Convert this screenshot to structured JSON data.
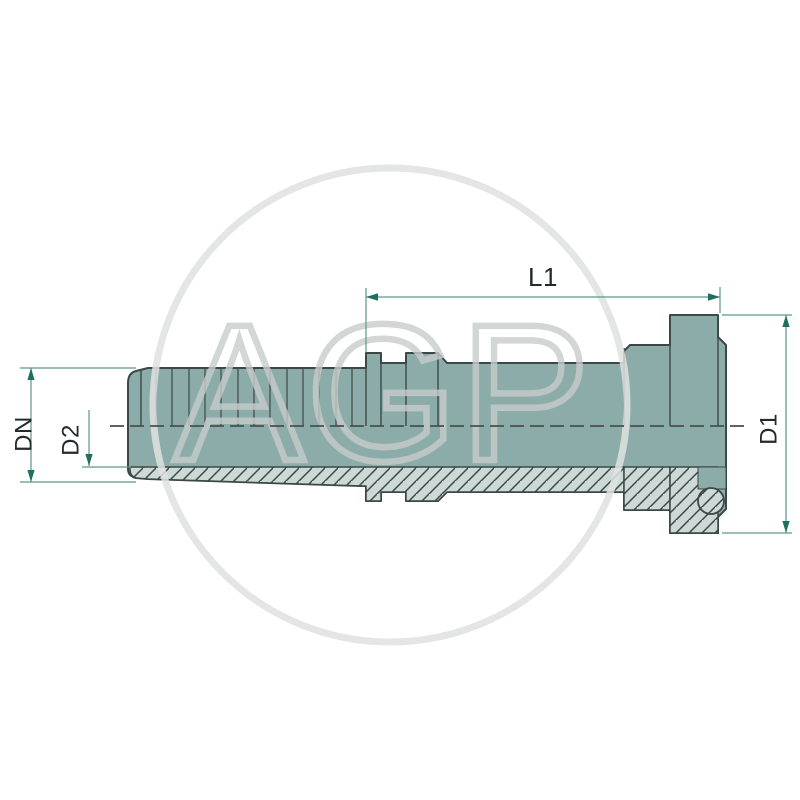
{
  "drawing": {
    "title": "hydraulic-flange-hose-fitting-section-drawing",
    "dimensions": {
      "length_label": "L1",
      "nominal_diameter_label": "DN",
      "inner_diameter_label": "D2",
      "flange_diameter_label": "D1"
    },
    "watermark": {
      "text": "AGP"
    },
    "colors": {
      "background": "#ffffff",
      "body_fill": "#8cacaa",
      "section_hatch_fill": "#cdd9d6",
      "outline": "#3c4846",
      "dimension_line": "#5b978a",
      "dimension_arrow": "#1d6f5e",
      "label_text": "#24292b",
      "centerline": "#4a4f4f",
      "watermark": "#c9cecd"
    }
  }
}
